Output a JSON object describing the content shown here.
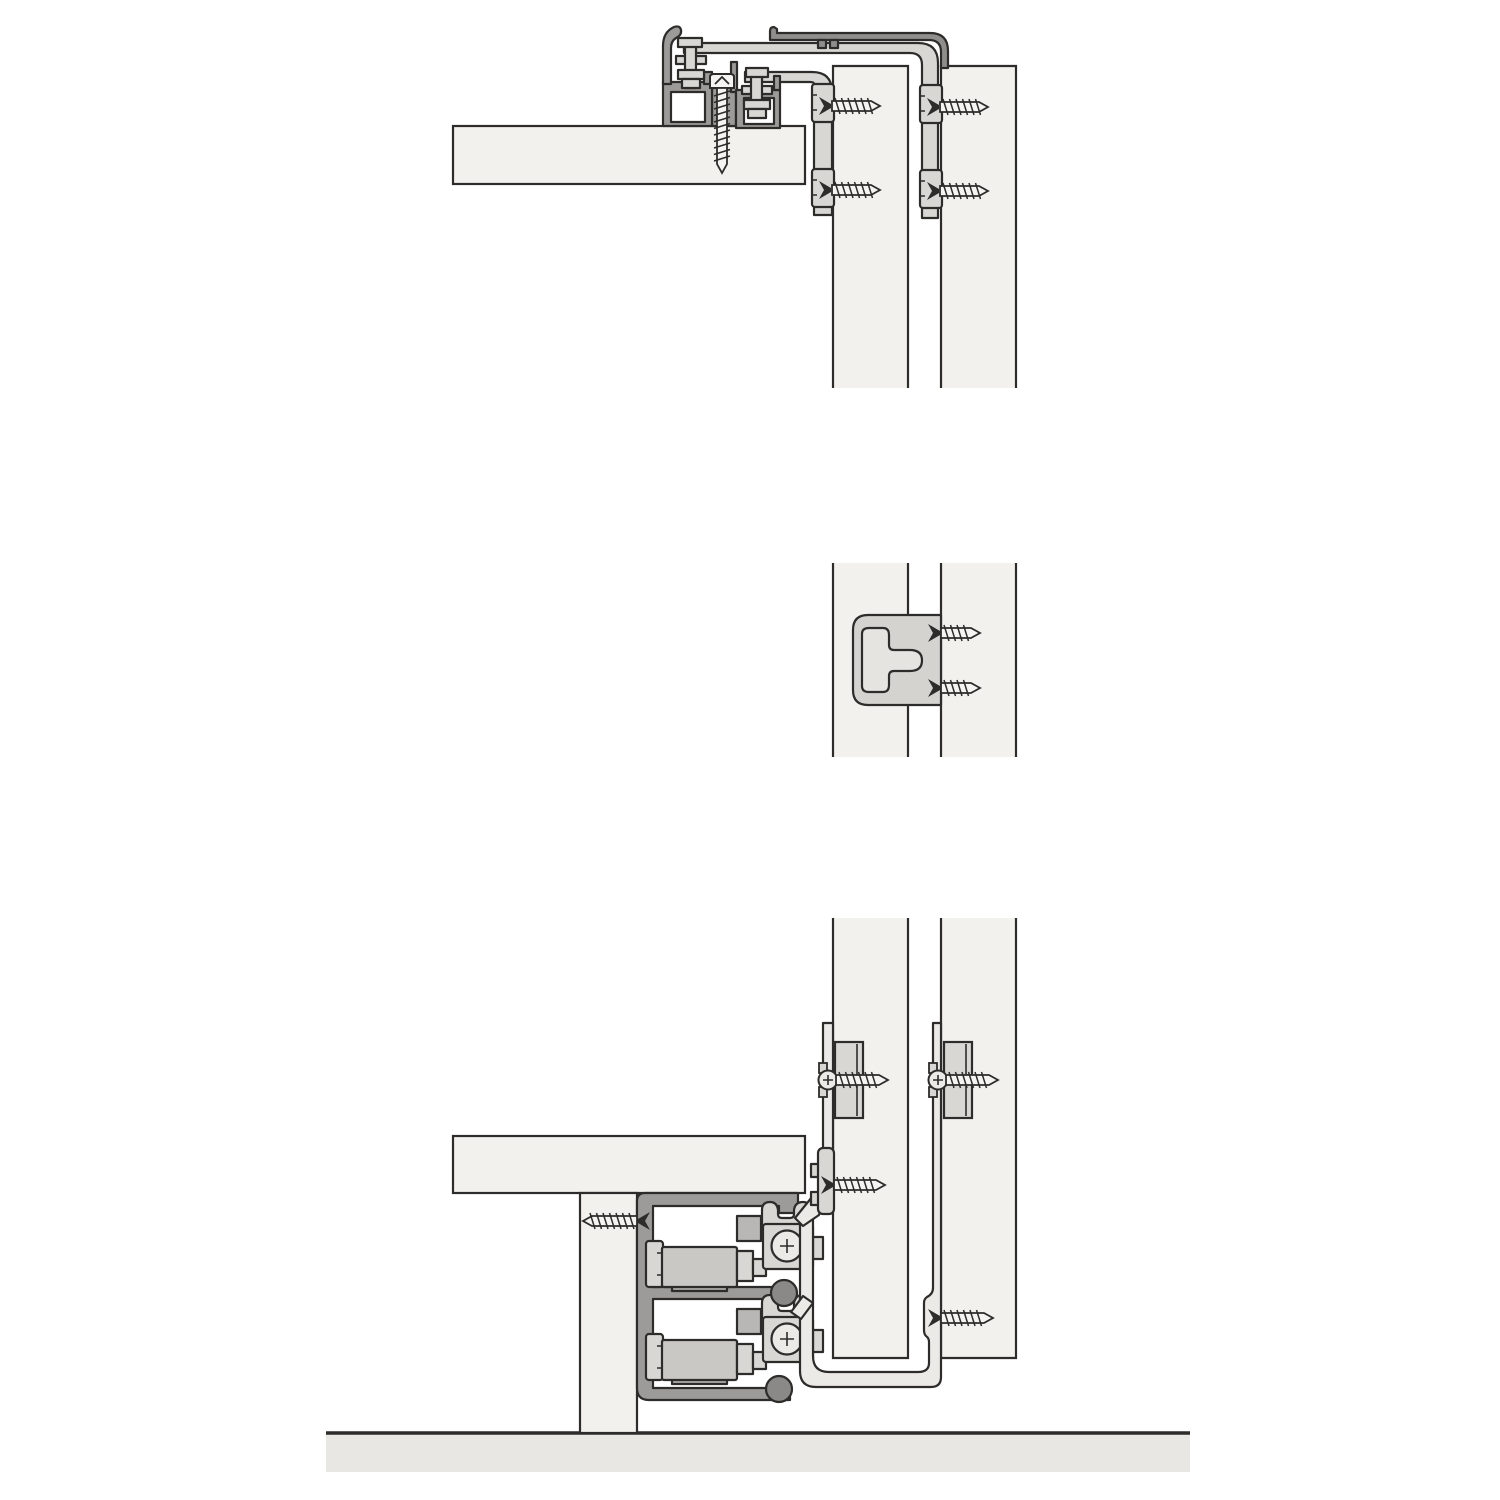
{
  "figure": {
    "kind": "technical-sectional-drawing",
    "subject": "sliding-door-fitting-installation-details",
    "sections": [
      "top-track-detail",
      "middle-clip-detail",
      "bottom-track-detail"
    ]
  },
  "canvas": {
    "width": 1500,
    "height": 1500
  },
  "palette": {
    "background": "#ffffff",
    "line": "#2d2c2a",
    "board": "#f2f1ee",
    "floor": "#e9e7e3",
    "profile_dark": "#9c9b99",
    "profile_mid": "#c9c8c5",
    "hardware_light": "#d8d7d4",
    "hardware_lighter": "#eceae7",
    "cover_dark": "#8f8e8c",
    "knob_dark": "#8a8987",
    "bracket_fill": "#d4d3d0",
    "bracket_inner": "#e5e4e1",
    "block_mid": "#b8b7b5",
    "block_dark": "#adacaa",
    "screw_fill": "#f5f4f2"
  },
  "floor": {
    "id": "floor-slab",
    "x": 326,
    "y": 1433,
    "w": 864,
    "h": 39
  },
  "boards": [
    {
      "id": "top-shelf-board",
      "x": 453,
      "y": 126,
      "w": 352,
      "h": 58
    },
    {
      "id": "bottom-shelf-board",
      "x": 453,
      "y": 1136,
      "w": 352,
      "h": 57
    },
    {
      "id": "support-leg",
      "x": 580,
      "y": 1193,
      "w": 57,
      "h": 240
    }
  ],
  "panels": [
    {
      "id": "top-left-door-panel",
      "x": 833,
      "y": 66,
      "w": 75,
      "h": 322,
      "edges": "top"
    },
    {
      "id": "top-right-door-panel",
      "x": 941,
      "y": 66,
      "w": 75,
      "h": 322,
      "edges": "top"
    },
    {
      "id": "middle-left-door-panel",
      "x": 833,
      "y": 563,
      "w": 75,
      "h": 194,
      "edges": "sides"
    },
    {
      "id": "middle-right-door-panel",
      "x": 941,
      "y": 563,
      "w": 75,
      "h": 194,
      "edges": "sides"
    },
    {
      "id": "bottom-left-door-panel",
      "x": 833,
      "y": 918,
      "w": 75,
      "h": 440,
      "edges": "bottom"
    },
    {
      "id": "bottom-right-door-panel",
      "x": 941,
      "y": 918,
      "w": 75,
      "h": 440,
      "edges": "bottom"
    }
  ],
  "spacers": [
    {
      "id": "left-spacer-block",
      "x": 835,
      "y": 1042,
      "w": 28,
      "h": 76,
      "inner_line_x": 857
    },
    {
      "id": "right-spacer-block",
      "x": 944,
      "y": 1042,
      "w": 28,
      "h": 76,
      "inner_line_x": 966
    }
  ],
  "screws": [
    {
      "id": "top-track-screw",
      "head": "flat",
      "dir": "down",
      "x": 722,
      "y": 88,
      "len": 85
    },
    {
      "id": "top-left-strip-screw-upper",
      "head": "countersunk",
      "dir": "right",
      "x": 832,
      "y": 106,
      "len": 48
    },
    {
      "id": "top-left-strip-screw-lower",
      "head": "countersunk",
      "dir": "right",
      "x": 832,
      "y": 190,
      "len": 48
    },
    {
      "id": "top-right-strip-screw-upper",
      "head": "countersunk",
      "dir": "right",
      "x": 940,
      "y": 107,
      "len": 48
    },
    {
      "id": "top-right-strip-screw-lower",
      "head": "countersunk",
      "dir": "right",
      "x": 940,
      "y": 191,
      "len": 48
    },
    {
      "id": "middle-clip-screw-upper",
      "head": "countersunk",
      "dir": "right",
      "x": 941,
      "y": 633,
      "len": 39
    },
    {
      "id": "middle-clip-screw-lower",
      "head": "countersunk",
      "dir": "right",
      "x": 941,
      "y": 688,
      "len": 39
    },
    {
      "id": "bottom-track-screw",
      "head": "countersunk",
      "dir": "left",
      "x": 637,
      "y": 1221,
      "len": 54
    },
    {
      "id": "left-spacer-screw",
      "head": "washer",
      "dir": "right",
      "x": 836,
      "y": 1080,
      "len": 52
    },
    {
      "id": "right-spacer-screw",
      "head": "washer",
      "dir": "right",
      "x": 946,
      "y": 1080,
      "len": 52
    },
    {
      "id": "left-hanger-screw",
      "head": "countersunk",
      "dir": "right",
      "x": 834,
      "y": 1185,
      "len": 51
    },
    {
      "id": "right-hanger-screw",
      "head": "countersunk",
      "dir": "right",
      "x": 941,
      "y": 1318,
      "len": 52
    }
  ],
  "parts": {
    "top_cover_profile": "cover profile",
    "top_rail_upper": "upper mounting rail",
    "top_rail_lower": "lower mounting rail",
    "top_track_left": "top track profile front",
    "top_track_right": "top track profile rear",
    "top_glider_left": "top glide fitting front",
    "top_glider_right": "top glide fitting rear",
    "middle_clip": "mid mounting clip",
    "bottom_track": "double bottom running track",
    "upper_carriage": "front roller carriage",
    "lower_carriage": "rear roller carriage",
    "left_hanger": "front door hanger bracket",
    "right_hanger": "rear door hanger bracket"
  }
}
